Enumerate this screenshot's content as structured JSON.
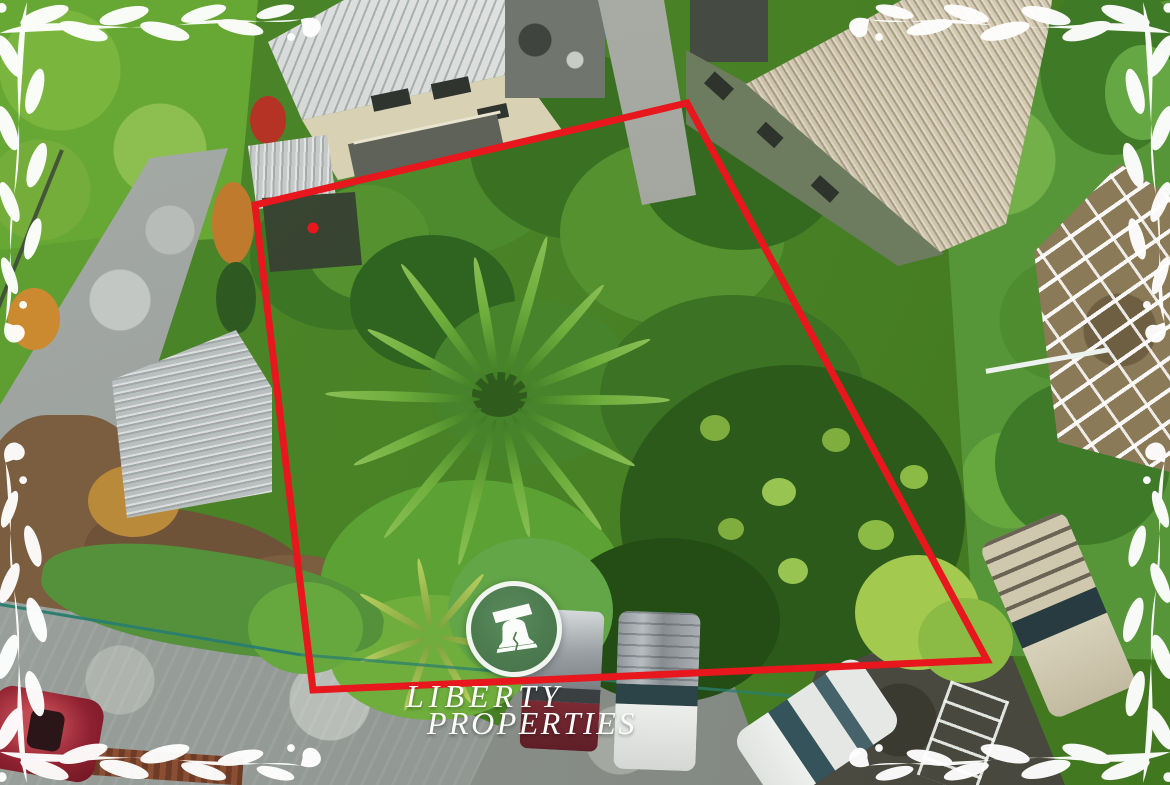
{
  "watermark": {
    "line1": "LIBERTY",
    "line2": "PROPERTIES",
    "logo_icon": "liberty-bell",
    "logo_circle_color": "#4d7b50",
    "logo_ring_color": "#f8faf6",
    "text_color": "#fcfdfa"
  },
  "property_boundary": {
    "color": "#e8161d",
    "stroke_width": 7,
    "vertices": "687,103 255,205 313,690 987,660",
    "marker_dot": {
      "x": 313,
      "y": 228,
      "r": 5.5
    }
  },
  "decorations": {
    "corner_ornament_color": "#ffffff",
    "corner_ornament_style": "vine-leaves"
  }
}
